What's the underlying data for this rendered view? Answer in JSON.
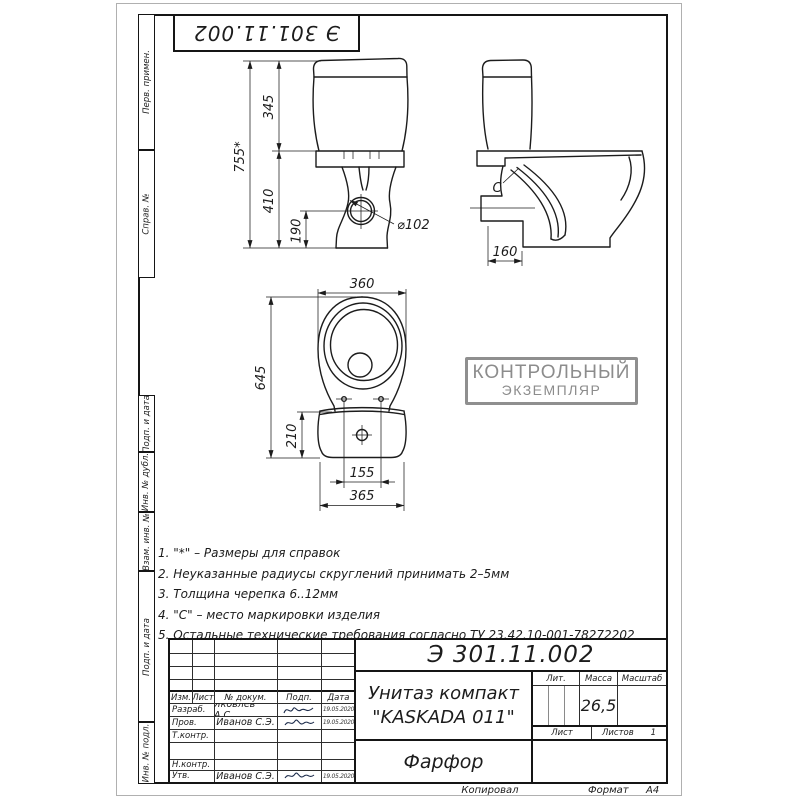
{
  "stamps": {
    "top": "Э 301.11.002",
    "control_line1": "КОНТРОЛЬНЫЙ",
    "control_line2": "ЭКЗЕМПЛЯР"
  },
  "side_labels": [
    "Перв. примен.",
    "Справ. №",
    "Подп. и дата",
    "Инв. № дубл.",
    "Взам. инв. №",
    "Подп. и дата",
    "Инв. № подл."
  ],
  "notes": [
    "1. \"*\" – Размеры для справок",
    "2. Неуказанные радиусы скруглений принимать 2–5мм",
    "3. Толщина черепка 6..12мм",
    "4. \"С\" – место маркировки изделия",
    "5. Остальные технические требования согласно ТУ 23.42.10-001-78272202"
  ],
  "dims": {
    "front": {
      "total": "755*",
      "tank": "345",
      "bowl": "410",
      "outlet": "190",
      "outlet_dia": "⌀102"
    },
    "side": {
      "mark": "С",
      "offset": "160"
    },
    "plan": {
      "width": "360",
      "length": "645",
      "tank_depth": "210",
      "bolts": "155",
      "tank_width": "365"
    }
  },
  "title_block": {
    "designation": "Э 301.11.002",
    "name_line1": "Унитаз компакт",
    "name_line2": "\"KASKADA 011\"",
    "material": "Фарфор",
    "cols": {
      "izm": "Изм.",
      "list": "Лист",
      "doc": "№ докум.",
      "sign": "Подп.",
      "date": "Дата"
    },
    "rows": [
      {
        "role": "Разраб.",
        "name": "Яковлев А.С.",
        "date": "19.05.2020"
      },
      {
        "role": "Пров.",
        "name": "Иванов С.Э.",
        "date": "19.05.2020"
      },
      {
        "role": "Т.контр.",
        "name": "",
        "date": ""
      },
      {
        "role": "Н.контр.",
        "name": "",
        "date": ""
      },
      {
        "role": "Утв.",
        "name": "Иванов С.Э.",
        "date": "19.05.2020"
      }
    ],
    "lit": "Лит.",
    "mass": "Масса",
    "scale": "Масштаб",
    "mass_value": "26,5",
    "sheet": "Лист",
    "sheets": "Листов",
    "sheets_value": "1",
    "copied": "Копировал",
    "format": "Формат",
    "format_value": "А4"
  }
}
